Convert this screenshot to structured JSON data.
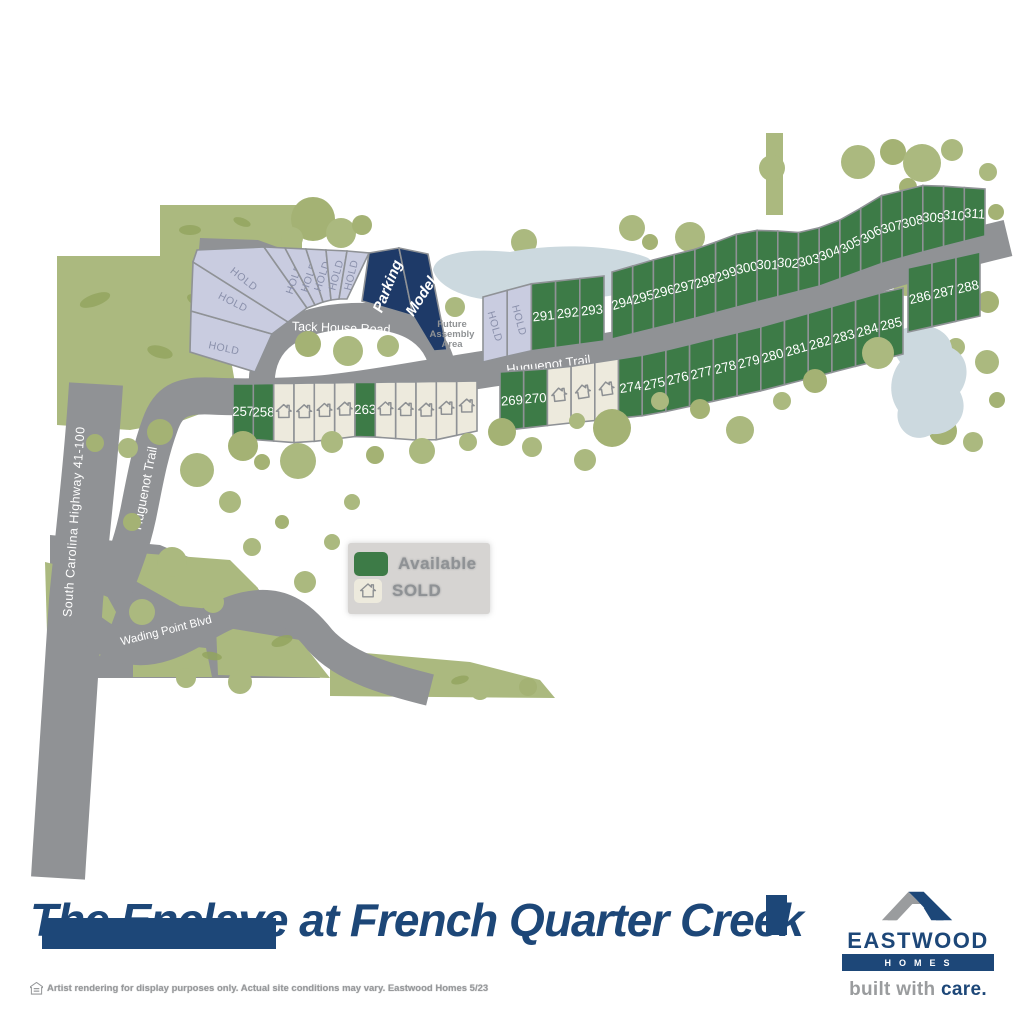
{
  "title": {
    "text": "The Enclave at French Quarter Creek"
  },
  "branding": {
    "name": "EASTWOOD",
    "homes": "HOMES",
    "tagline_gray": "built with ",
    "tagline_accent": "care."
  },
  "disclaimer": {
    "text": "Artist rendering for display purposes only. Actual site conditions may vary. Eastwood Homes 5/23"
  },
  "legend": {
    "available_label": "Available",
    "sold_label": "SOLD"
  },
  "roads": {
    "tack_house": "Tack House Road",
    "huguenot_upper": "Huguenot Trail",
    "huguenot_lower": "Huguenot Trail",
    "highway": "South Carolina Highway 41-100",
    "wading_point": "Wading Point Blvd"
  },
  "areas": {
    "future_assembly": "Future Assembly Area",
    "future_assembly_lines": [
      "Future",
      "Assembly",
      "Area"
    ],
    "parking_label": "Parking",
    "model_label": "Model",
    "hold_label": "HOLD"
  },
  "colors": {
    "available": "#3d7b47",
    "sold": "#edeadd",
    "hold": "#c9cce0",
    "model_parking": "#1e3a68",
    "road": "#909295",
    "water": "#ccd9df",
    "vegetation": "#abb97f",
    "vegetation_dark": "#93a45f",
    "brand_navy": "#1d4778",
    "gray_text": "#97999b",
    "lot_border": "#8f9296",
    "hold_text": "#8a90ab"
  },
  "lots": {
    "lower_a": [
      {
        "label": "257",
        "status": "available"
      },
      {
        "label": "258",
        "status": "available"
      },
      {
        "label": "",
        "status": "sold"
      },
      {
        "label": "",
        "status": "sold"
      },
      {
        "label": "",
        "status": "sold"
      },
      {
        "label": "",
        "status": "sold"
      },
      {
        "label": "263",
        "status": "available"
      },
      {
        "label": "",
        "status": "sold"
      },
      {
        "label": "",
        "status": "sold"
      },
      {
        "label": "",
        "status": "sold"
      },
      {
        "label": "",
        "status": "sold"
      },
      {
        "label": "",
        "status": "sold"
      }
    ],
    "lower_b": [
      {
        "label": "269",
        "status": "available"
      },
      {
        "label": "270",
        "status": "available"
      },
      {
        "label": "",
        "status": "sold"
      },
      {
        "label": "",
        "status": "sold"
      },
      {
        "label": "",
        "status": "sold"
      },
      {
        "label": "274",
        "status": "available"
      },
      {
        "label": "275",
        "status": "available"
      },
      {
        "label": "276",
        "status": "available"
      },
      {
        "label": "277",
        "status": "available"
      },
      {
        "label": "278",
        "status": "available"
      },
      {
        "label": "279",
        "status": "available"
      },
      {
        "label": "280",
        "status": "available"
      },
      {
        "label": "281",
        "status": "available"
      },
      {
        "label": "282",
        "status": "available"
      },
      {
        "label": "283",
        "status": "available"
      },
      {
        "label": "284",
        "status": "available"
      },
      {
        "label": "285",
        "status": "available"
      }
    ],
    "lower_c": [
      {
        "label": "286",
        "status": "available"
      },
      {
        "label": "287",
        "status": "available"
      },
      {
        "label": "288",
        "status": "available"
      }
    ],
    "upper_a": [
      {
        "label": "HOLD",
        "status": "hold"
      },
      {
        "label": "HOLD",
        "status": "hold"
      },
      {
        "label": "291",
        "status": "available"
      },
      {
        "label": "292",
        "status": "available"
      },
      {
        "label": "293",
        "status": "available"
      }
    ],
    "upper_b": [
      {
        "label": "294",
        "status": "available"
      },
      {
        "label": "295",
        "status": "available"
      },
      {
        "label": "296",
        "status": "available"
      },
      {
        "label": "297",
        "status": "available"
      },
      {
        "label": "298",
        "status": "available"
      },
      {
        "label": "299",
        "status": "available"
      },
      {
        "label": "300",
        "status": "available"
      },
      {
        "label": "301",
        "status": "available"
      },
      {
        "label": "302",
        "status": "available"
      },
      {
        "label": "303",
        "status": "available"
      },
      {
        "label": "304",
        "status": "available"
      },
      {
        "label": "305",
        "status": "available"
      },
      {
        "label": "306",
        "status": "available"
      },
      {
        "label": "307",
        "status": "available"
      },
      {
        "label": "308",
        "status": "available"
      },
      {
        "label": "309",
        "status": "available"
      },
      {
        "label": "310",
        "status": "available"
      },
      {
        "label": "311",
        "status": "available"
      }
    ],
    "fan_left": [
      "HOLD",
      "HOLD",
      "HOLD"
    ],
    "fan_upper": [
      "HOLD",
      "HOLD",
      "HOLD",
      "HOLD",
      "HOLD"
    ]
  }
}
